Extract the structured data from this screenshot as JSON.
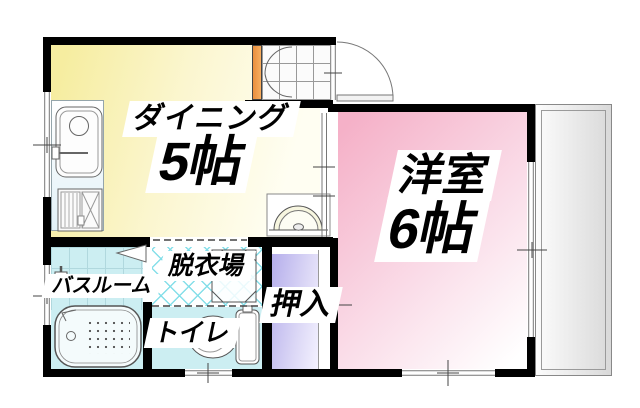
{
  "floorplan": {
    "type": "apartment-floor-plan",
    "rooms": {
      "dining": {
        "name": "ダイニング",
        "size": "5帖"
      },
      "western": {
        "name": "洋室",
        "size": "6帖"
      },
      "bathroom": {
        "name": "バスルーム"
      },
      "dressing": {
        "name": "脱衣場"
      },
      "toilet": {
        "name": "トイレ"
      },
      "closet": {
        "name": "押入"
      }
    },
    "colors": {
      "wall": "#000000",
      "dining_floor": "#f6eda0",
      "western_floor": "#f5b1c8",
      "closet_floor": "#b5aeeb",
      "wet_area_floor": "#cceef2",
      "dressing_hatch": "#7fdde8",
      "entrance_accent": "#f09a4a",
      "balcony_floor": "#d9d9d9"
    }
  }
}
